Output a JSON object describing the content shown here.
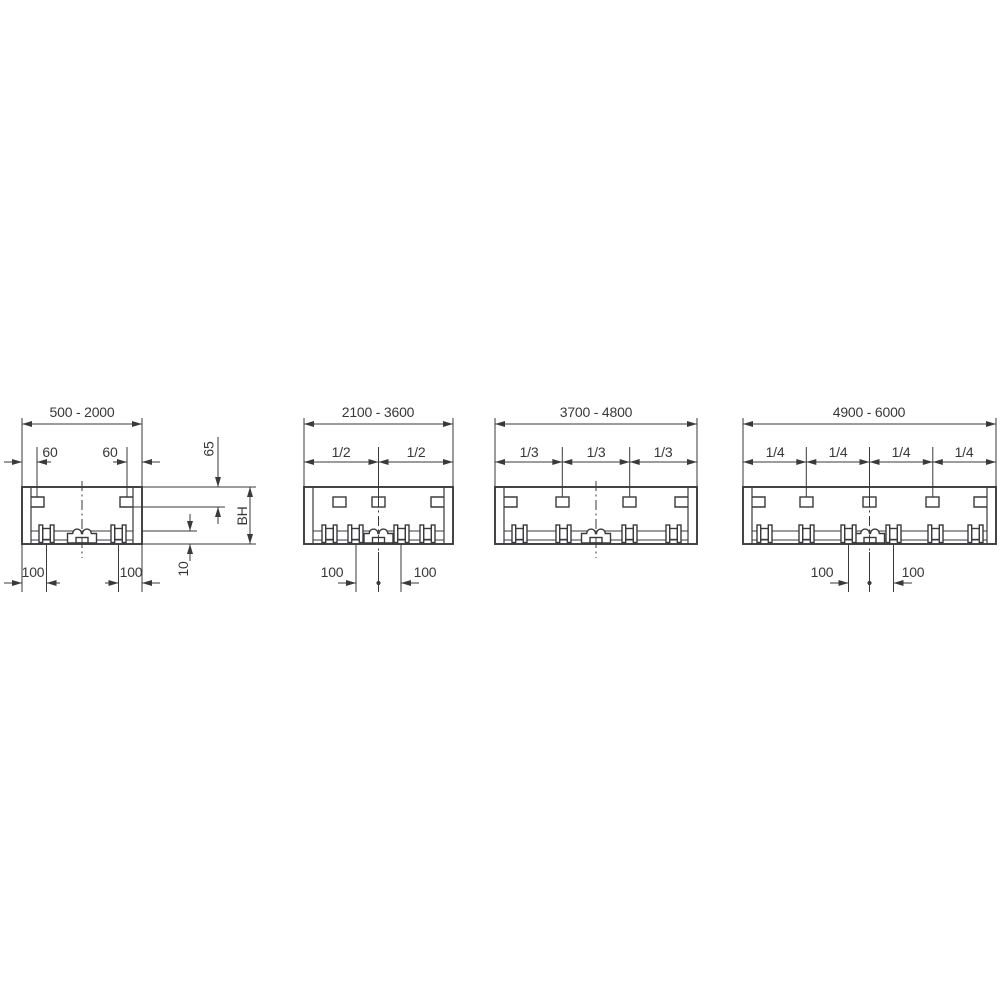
{
  "colors": {
    "background": "#ffffff",
    "line": "#3a3a3c"
  },
  "diagrams": [
    {
      "range_label": "500 - 2000",
      "sub_dims": [
        "60",
        "60"
      ],
      "bottom_dims": [
        "100",
        "100"
      ],
      "side_dims": {
        "top": "65",
        "height": "BH",
        "bottom": "10"
      }
    },
    {
      "range_label": "2100 - 3600",
      "sub_dims": [
        "1/2",
        "1/2"
      ],
      "bottom_dims": [
        "100",
        "100"
      ]
    },
    {
      "range_label": "3700 - 4800",
      "sub_dims": [
        "1/3",
        "1/3",
        "1/3"
      ]
    },
    {
      "range_label": "4900 - 6000",
      "sub_dims": [
        "1/4",
        "1/4",
        "1/4",
        "1/4"
      ],
      "bottom_dims": [
        "100",
        "100"
      ]
    }
  ]
}
